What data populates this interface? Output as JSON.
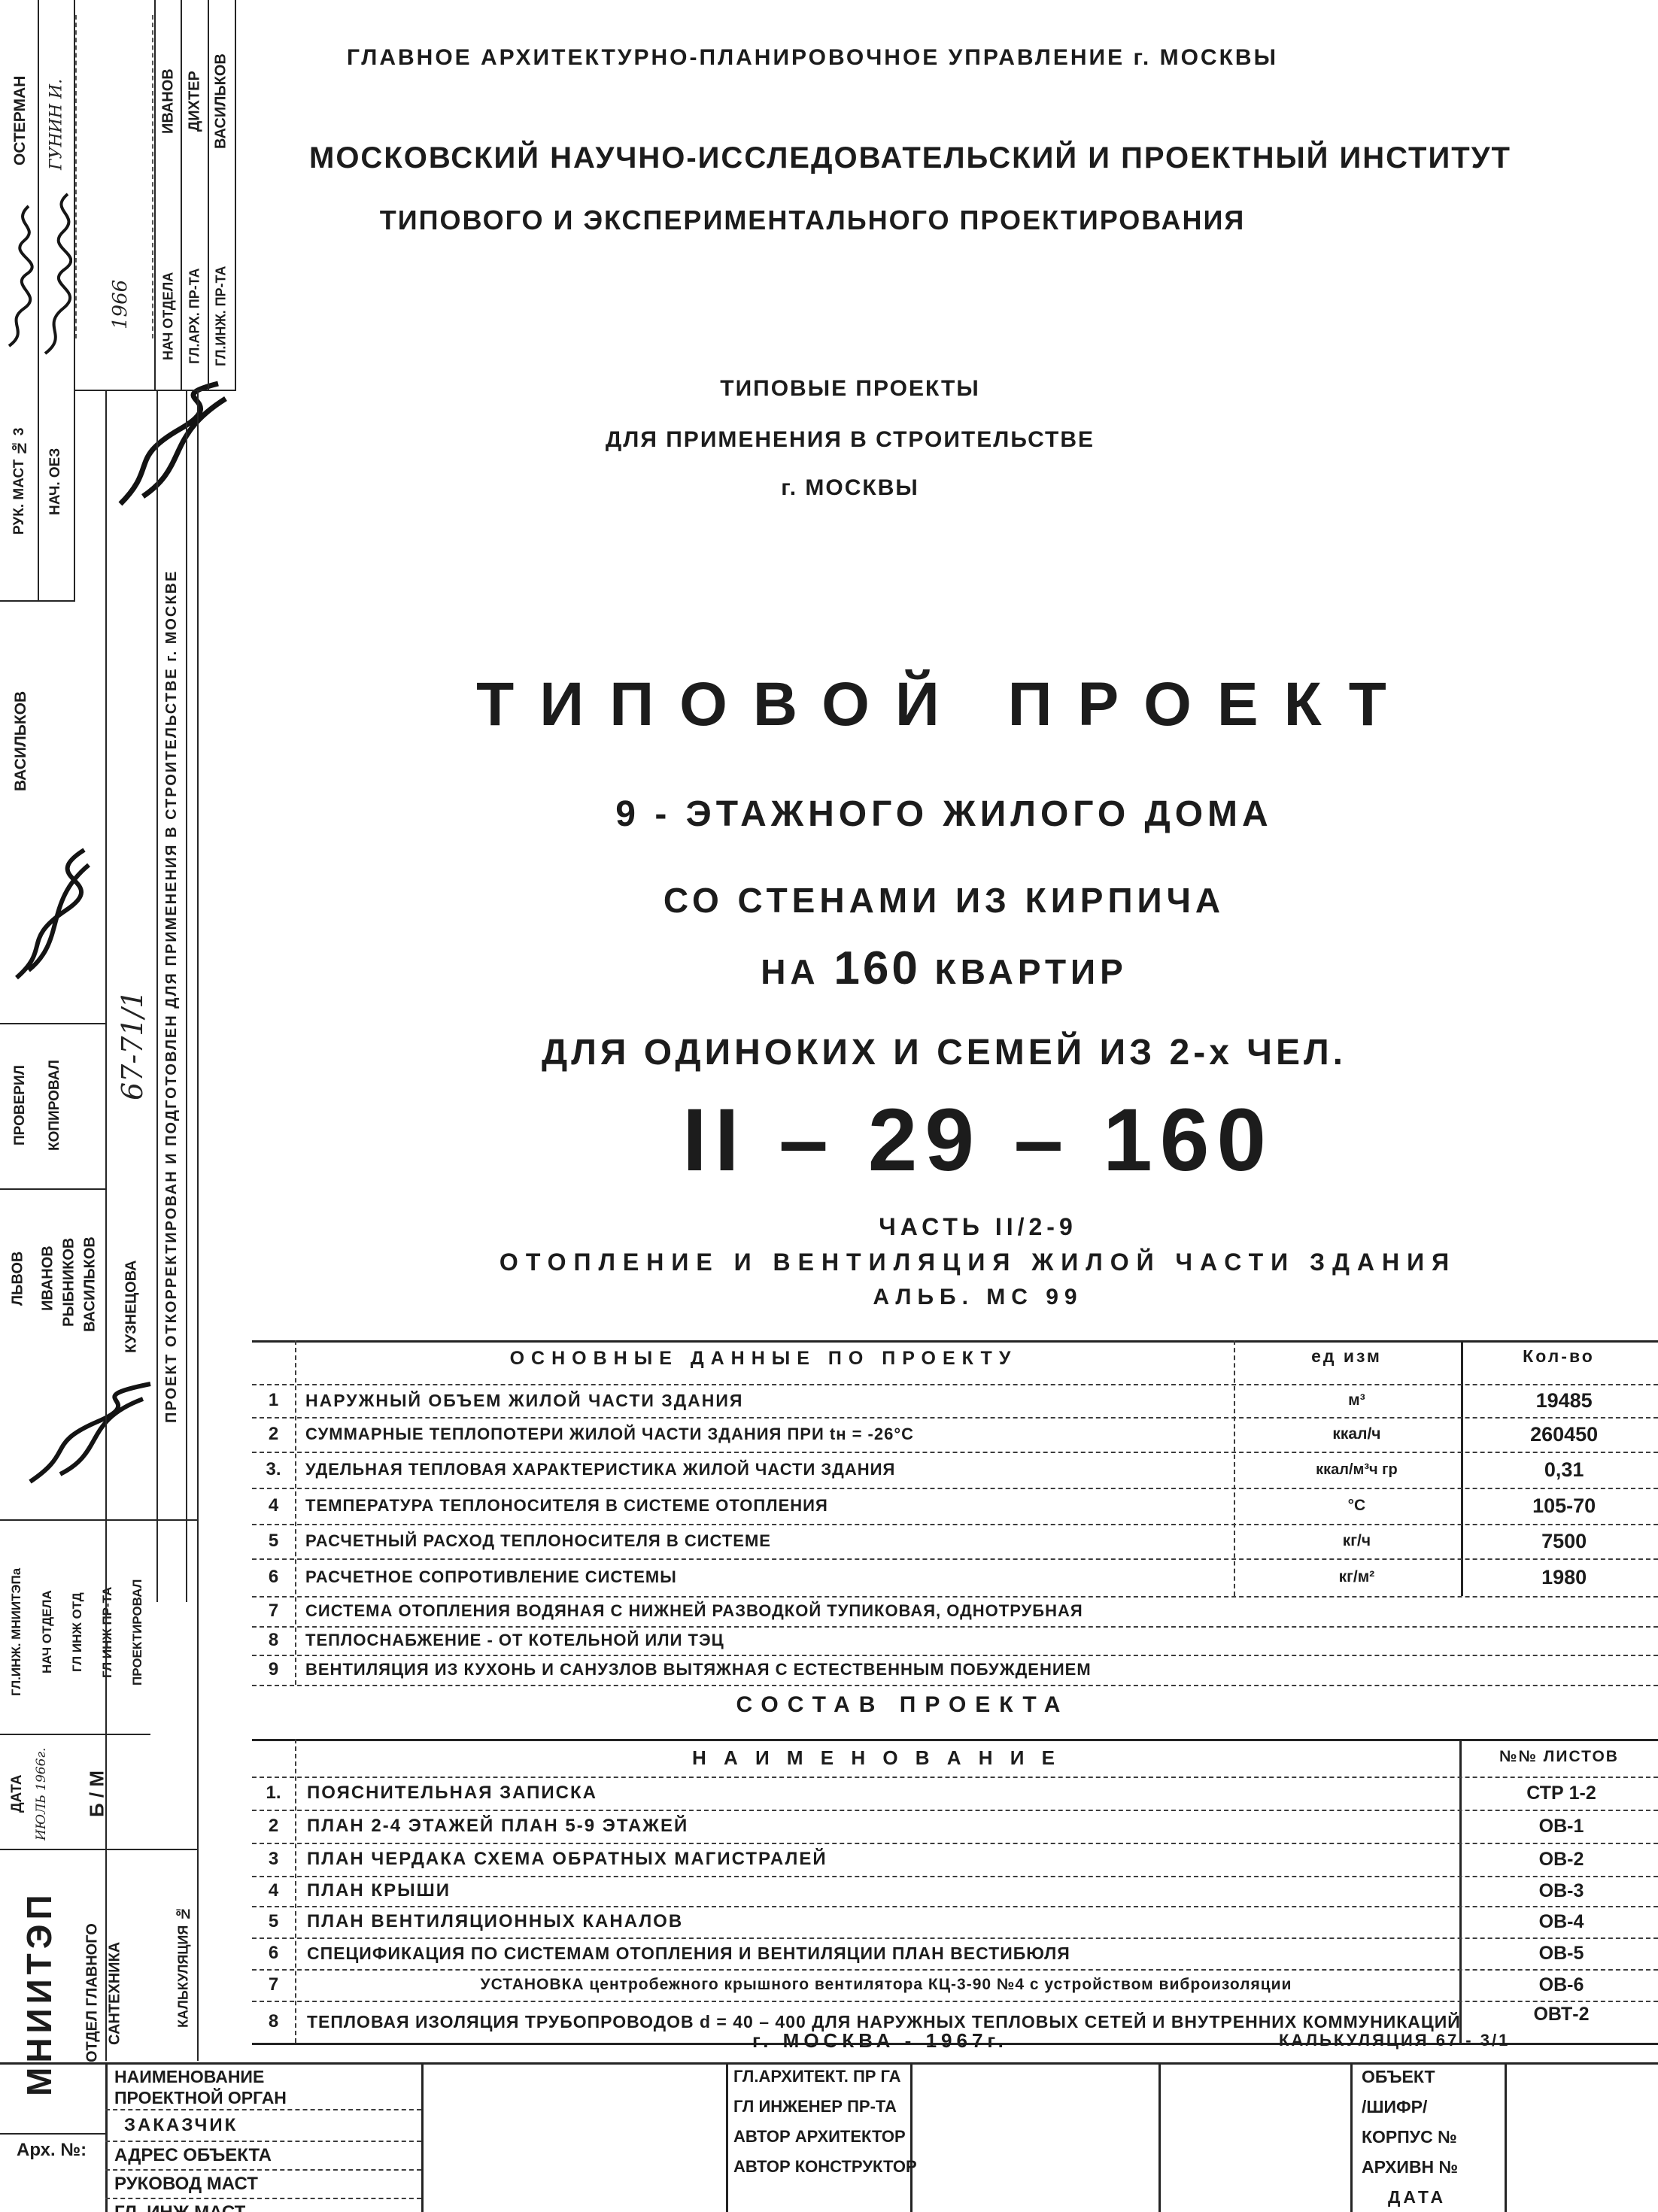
{
  "header": {
    "line1": "ГЛАВНОЕ  АРХИТЕКТУРНО-ПЛАНИРОВОЧНОЕ  УПРАВЛЕНИЕ  г. МОСКВЫ",
    "line2": "МОСКОВСКИЙ  НАУЧНО-ИССЛЕДОВАТЕЛЬСКИЙ  И  ПРОЕКТНЫЙ  ИНСТИТУТ",
    "line3": "ТИПОВОГО  И  ЭКСПЕРИМЕНТАЛЬНОГО  ПРОЕКТИРОВАНИЯ",
    "series1": "ТИПОВЫЕ  ПРОЕКТЫ",
    "series2": "ДЛЯ  ПРИМЕНЕНИЯ  В  СТРОИТЕЛЬСТВЕ",
    "series3": "г. МОСКВЫ"
  },
  "title": {
    "main": "ТИПОВОЙ  ПРОЕКТ",
    "line2": "9 - ЭТАЖНОГО  ЖИЛОГО  ДОМА",
    "line3": "СО  СТЕНАМИ  ИЗ  КИРПИЧА",
    "line4a": "НА",
    "line4b": "160",
    "line4c": "КВАРТИР",
    "line5": "ДЛЯ  ОДИНОКИХ  И  СЕМЕЙ  ИЗ  2-х  ЧЕЛ.",
    "index": "II – 29 – 160",
    "part": "ЧАСТЬ II/2-9",
    "subject": "ОТОПЛЕНИЕ И ВЕНТИЛЯЦИЯ ЖИЛОЙ ЧАСТИ ЗДАНИЯ",
    "album": "АЛЬБ. МС 99"
  },
  "data_table": {
    "title": "ОСНОВНЫЕ  ДАННЫЕ  ПО  ПРОЕКТУ",
    "unit_header": "ед изм",
    "qty_header": "Кол-во",
    "rows": [
      {
        "num": "1",
        "name": "НАРУЖНЫЙ ОБЪЕМ ЖИЛОЙ ЧАСТИ ЗДАНИЯ",
        "unit": "м³",
        "qty": "19485"
      },
      {
        "num": "2",
        "name": "СУММАРНЫЕ ТЕПЛОПОТЕРИ ЖИЛОЙ ЧАСТИ ЗДАНИЯ  ПРИ tн = -26°С",
        "unit": "ккал/ч",
        "qty": "260450"
      },
      {
        "num": "3.",
        "name": "УДЕЛЬНАЯ ТЕПЛОВАЯ ХАРАКТЕРИСТИКА ЖИЛОЙ ЧАСТИ ЗДАНИЯ",
        "unit": "ккал/м³ч гр",
        "qty": "0,31"
      },
      {
        "num": "4",
        "name": "ТЕМПЕРАТУРА ТЕПЛОНОСИТЕЛЯ В СИСТЕМЕ ОТОПЛЕНИЯ",
        "unit": "°С",
        "qty": "105-70"
      },
      {
        "num": "5",
        "name": "РАСЧЕТНЫЙ РАСХОД ТЕПЛОНОСИТЕЛЯ В СИСТЕМЕ",
        "unit": "кг/ч",
        "qty": "7500"
      },
      {
        "num": "6",
        "name": "РАСЧЕТНОЕ СОПРОТИВЛЕНИЕ СИСТЕМЫ",
        "unit": "кг/м²",
        "qty": "1980"
      },
      {
        "num": "7",
        "name": "СИСТЕМА ОТОПЛЕНИЯ  ВОДЯНАЯ С НИЖНЕЙ РАЗВОДКОЙ  ТУПИКОВАЯ, ОДНОТРУБНАЯ",
        "unit": "",
        "qty": ""
      },
      {
        "num": "8",
        "name": "ТЕПЛОСНАБЖЕНИЕ - ОТ КОТЕЛЬНОЙ ИЛИ ТЭЦ",
        "unit": "",
        "qty": ""
      },
      {
        "num": "9",
        "name": "ВЕНТИЛЯЦИЯ ИЗ КУХОНЬ И САНУЗЛОВ  ВЫТЯЖНАЯ  С ЕСТЕСТВЕННЫМ ПОБУЖДЕНИЕМ",
        "unit": "",
        "qty": ""
      }
    ]
  },
  "contents_table": {
    "title": "СОСТАВ  ПРОЕКТА",
    "name_header": "Н А И М Е Н О В А Н И Е",
    "sheets_header": "№№ ЛИСТОВ",
    "rows": [
      {
        "num": "1.",
        "name": "ПОЯСНИТЕЛЬНАЯ  ЗАПИСКА",
        "sheet": "СТР 1-2"
      },
      {
        "num": "2",
        "name": "ПЛАН 2-4 ЭТАЖЕЙ  ПЛАН 5-9 ЭТАЖЕЙ",
        "sheet": "ОВ-1"
      },
      {
        "num": "3",
        "name": "ПЛАН ЧЕРДАКА  СХЕМА ОБРАТНЫХ МАГИСТРАЛЕЙ",
        "sheet": "ОВ-2"
      },
      {
        "num": "4",
        "name": "ПЛАН КРЫШИ",
        "sheet": "ОВ-3"
      },
      {
        "num": "5",
        "name": "ПЛАН ВЕНТИЛЯЦИОННЫХ КАНАЛОВ",
        "sheet": "ОВ-4"
      },
      {
        "num": "6",
        "name": "СПЕЦИФИКАЦИЯ ПО СИСТЕМАМ ОТОПЛЕНИЯ И ВЕНТИЛЯЦИИ  ПЛАН ВЕСТИБЮЛЯ",
        "sheet": "ОВ-5"
      },
      {
        "num": "7",
        "name": "УСТАНОВКА  центробежного крышного вентилятора  КЦ-3-90 №4  с устройством виброизоляции",
        "sheet": "ОВ-6"
      },
      {
        "num": "8",
        "name": "ТЕПЛОВАЯ ИЗОЛЯЦИЯ ТРУБОПРОВОДОВ d = 40 – 400 ДЛЯ НАРУЖНЫХ ТЕПЛОВЫХ СЕТЕЙ И ВНУТРЕННИХ КОММУНИКАЦИЙ",
        "sheet": "ОВТ-2"
      }
    ]
  },
  "footer": {
    "city_year": "г. МОСКВА - 1967г.",
    "calc_note": "КАЛЬКУЛЯЦИЯ 67 - 3/1",
    "org_label_1": "НАИМЕНОВАНИЕ",
    "org_label_2": "ПРОЕКТНОЙ ОРГАН",
    "org_label_3": "ЗАКАЗЧИК",
    "org_label_4": "АДРЕС ОБЪЕКТА",
    "org_label_5": "РУКОВОД МАСТ",
    "org_label_6": "ГЛ. ИНЖ  МАСТ",
    "person_label_1": "ГЛ.АРХИТЕКТ. ПР ГА",
    "person_label_2": "ГЛ ИНЖЕНЕР ПР-ТА",
    "person_label_3": "АВТОР АРХИТЕКТОР",
    "person_label_4": "АВТОР КОНСТРУКТОР",
    "object_label_1": "ОБЪЕКТ",
    "object_label_2": "/ШИФР/",
    "object_label_3": "КОРПУС №",
    "object_label_4": "АРХИВН №",
    "object_label_5": "ДАТА"
  },
  "sidebar": {
    "col1_label": "РУК. МАСТ № 3",
    "col1_name": "ОСТЕРМАН",
    "col2_label": "НАЧ. ОЕЗ",
    "col2_name": "ГУНИН И.",
    "col3_label": "НАЧ ОТДЕЛА",
    "col3_name": "ИВАНОВ",
    "col4_label": "ГЛ.АРХ. ПР-ТА",
    "col4_name": "ДИХТЕР",
    "col5_label": "ГЛ.ИНЖ. ПР-ТА",
    "col5_name": "ВАСИЛЬКОВ",
    "note_year": "1966",
    "checked_name": "ВАСИЛЬКОВ",
    "checked_label": "ПРОВЕРИЛ",
    "copied_label": "КОПИРОВАЛ",
    "name_lvov": "ЛЬВОВ",
    "name_ivanov": "ИВАНОВ",
    "name_rybnikov": "РЫБНИКОВ",
    "name_vasilkov": "ВАСИЛЬКОВ",
    "name_kuznetsova": "КУЗНЕЦОВА",
    "corrected_note": "ПРОЕКТ ОТКОРРЕКТИРОВАН И ПОДГОТОВЛЕН ДЛЯ ПРИМЕНЕНИЯ В СТРОИТЕЛЬСТВЕ г. МОСКВЕ",
    "calc_number": "67-71/1",
    "role_1": "ГЛ.ИНЖ. МНИИТЭПа",
    "role_2": "НАЧ ОТДЕЛА",
    "role_3": "ГЛ ИНЖ ОТД",
    "role_4": "ГЛ ИНЖ ПР-ТА",
    "role_5": "ПРОЕКТИРОВАЛ",
    "date_label": "ДАТА",
    "date_value": "ИЮЛЬ 1966г.",
    "bm": "Б / М",
    "org": "МНИИТЭП",
    "dept_1": "ОТДЕЛ ГЛАВНОГО",
    "dept_2": "САНТЕХНИКА",
    "arch_label": "Арх. №:",
    "calc_label": "КАЛЬКУЛЯЦИЯ №"
  }
}
